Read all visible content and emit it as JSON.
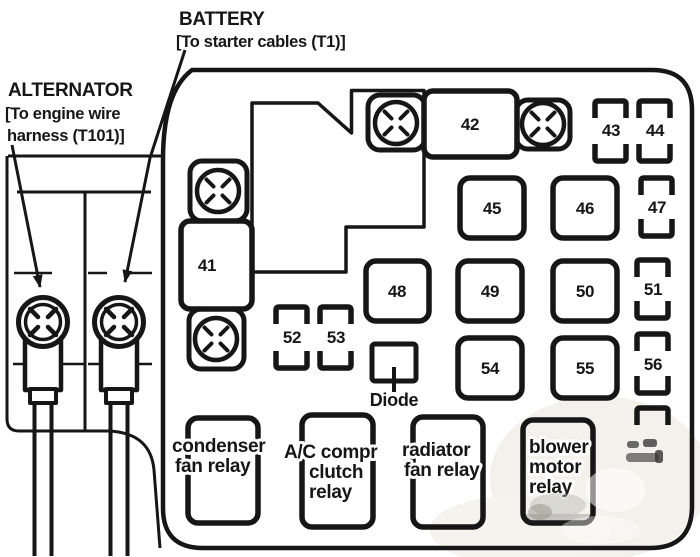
{
  "colors": {
    "ink": "#161616",
    "paper": "#ffffff"
  },
  "callouts": {
    "battery": {
      "title": "BATTERY",
      "detail": "[To starter cables (T1)]"
    },
    "alternator": {
      "title": "ALTERNATOR",
      "detail_line1": "[To engine wire",
      "detail_line2": "harness (T101)]"
    }
  },
  "fuses": {
    "f41": "41",
    "f42": "42",
    "f43": "43",
    "f44": "44",
    "f45": "45",
    "f46": "46",
    "f47": "47",
    "f48": "48",
    "f49": "49",
    "f50": "50",
    "f51": "51",
    "f52": "52",
    "f53": "53",
    "f54": "54",
    "f55": "55",
    "f56": "56"
  },
  "diode": {
    "label": "Diode"
  },
  "relays": {
    "condenser": {
      "line1": "condenser",
      "line2": "fan relay"
    },
    "ac_compressor": {
      "line1": "A/C compr",
      "line2": "clutch",
      "line3": "relay"
    },
    "radiator": {
      "line1": "radiator",
      "line2": "fan relay"
    },
    "blower": {
      "line1": "blower",
      "line2": "motor",
      "line3": "relay"
    }
  }
}
